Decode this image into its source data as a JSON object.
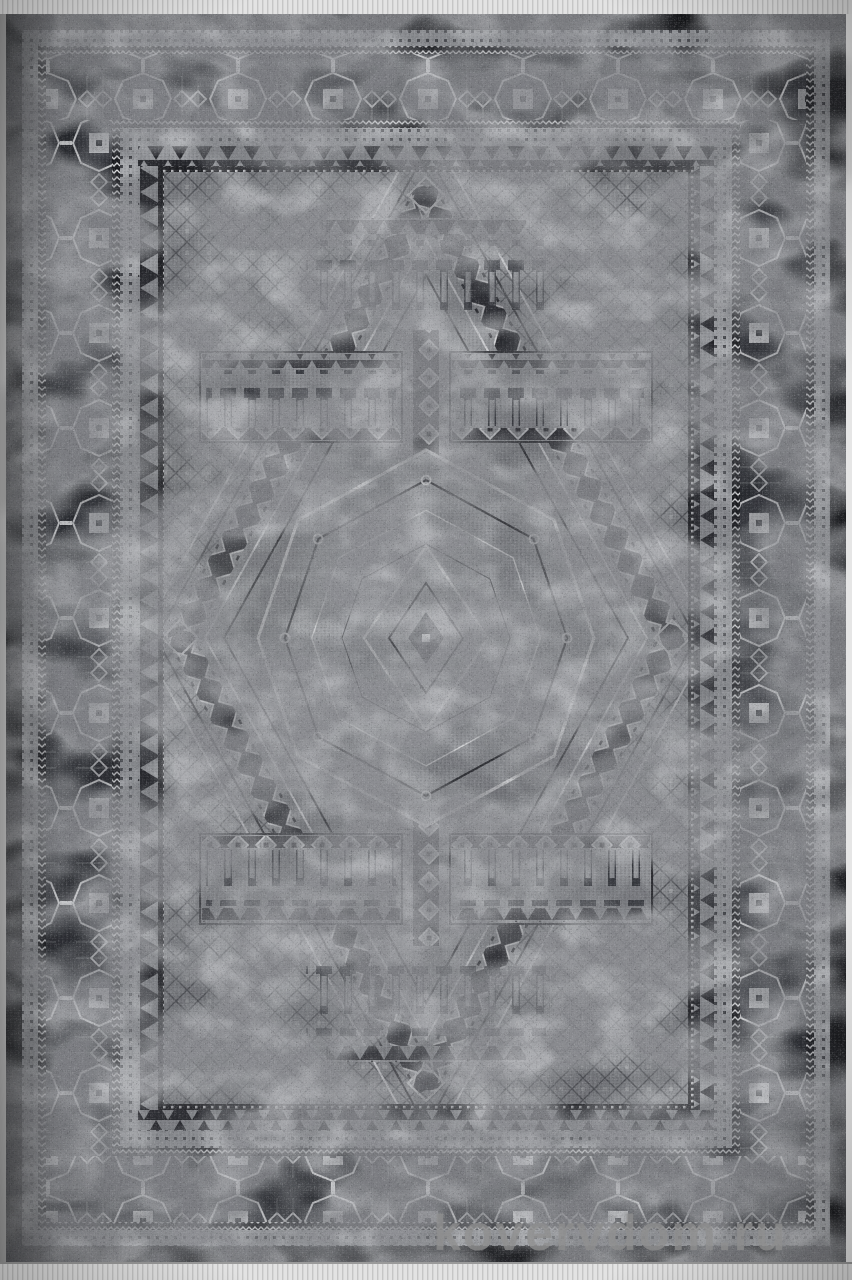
{
  "photo": {
    "subject": "distressed gray and black geometric oriental area rug, top view product photo",
    "watermark": {
      "text": "kovervdom.ru"
    }
  },
  "palette": {
    "selvage_black": "#17181b",
    "border_dark": "#26282d",
    "guard_light": "#a7a9ad",
    "field_gray": "#8b8d91",
    "motif_light": "#d7d8da",
    "motif_dark": "#2c2d32",
    "fringe_light": "#e3e3e3",
    "watermark_gray": "#8f8f8f"
  }
}
